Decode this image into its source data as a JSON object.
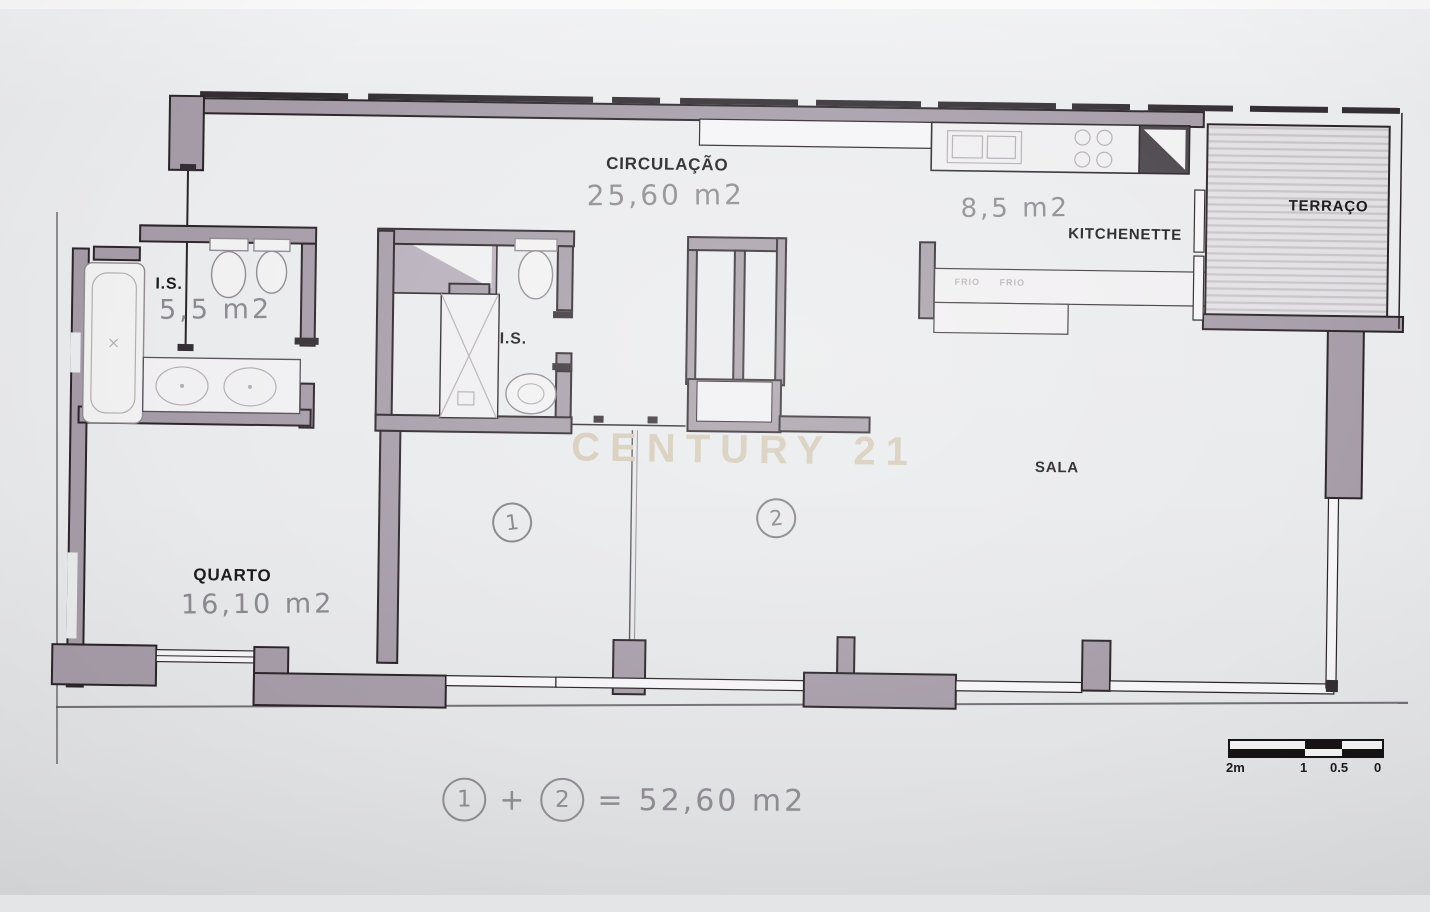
{
  "document": {
    "type": "apartment floor plan (scanned)",
    "watermark": "CENTURY 21"
  },
  "labels": {
    "circulacao": {
      "name": "CIRCULAÇÃO",
      "area": "25,60 m2"
    },
    "kitchenette": {
      "name": "KITCHENETTE",
      "area": "8,5 m2"
    },
    "terraco": {
      "name": "TERRAÇO"
    },
    "is1": {
      "name": "I.S.",
      "area": "5,5 m2"
    },
    "is2": {
      "name": "I.S."
    },
    "quarto": {
      "name": "QUARTO",
      "area": "16,10 m2"
    },
    "sala": {
      "name": "SALA"
    },
    "zone1": {
      "marker": "1"
    },
    "zone2": {
      "marker": "2"
    }
  },
  "counter_labels": {
    "left": "FRIO",
    "right": "FRIO"
  },
  "formula": {
    "term1": "1",
    "operator": "+",
    "term2": "2",
    "equals": "=",
    "result": "52,60 m2"
  },
  "scale_bar": {
    "t2m": "2m",
    "t1": "1",
    "t05": "0.5",
    "t0": "0"
  },
  "fixtures": [
    "bathtub",
    "toilet",
    "bidet",
    "double-washbasin",
    "shower",
    "washbasin",
    "kitchen-sink",
    "stove",
    "corner-cabinet",
    "terrace-decking",
    "wardrobe-block"
  ],
  "colors": {
    "wall": "#a59ca7",
    "outline": "#2b2529",
    "paper": "#e9eaec",
    "pencil": "#8b888f",
    "watermark": "#d4cab8"
  }
}
